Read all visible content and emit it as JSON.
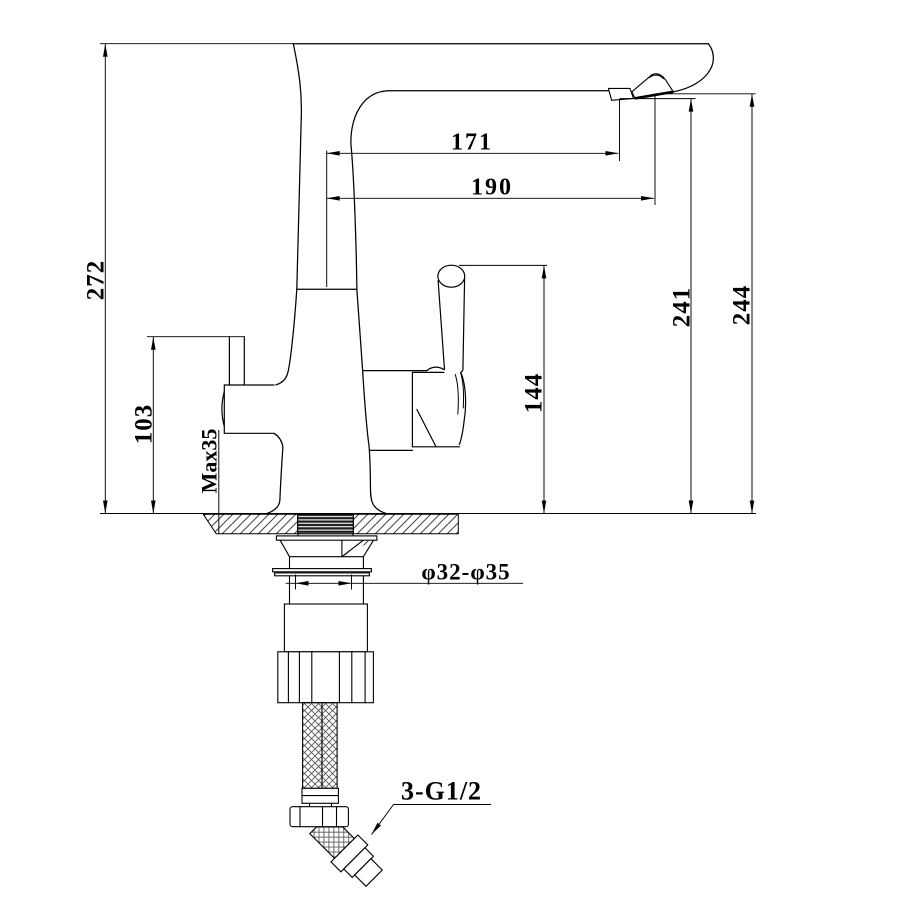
{
  "drawing": {
    "type": "technical-dimension-drawing",
    "subject": "kitchen faucet (3-way / filtered water mixer) front view with installation dimensions",
    "units": "mm",
    "line_color": "#000000",
    "background_color": "#ffffff",
    "dimensions": {
      "overall_height": "272",
      "spout_reach_inner": "171",
      "spout_reach_outer": "190",
      "outlet_height": "241",
      "tip_height": "244",
      "side_spout_height": "103",
      "max_deck_thickness": "Max35",
      "handle_top_height": "144",
      "mounting_hole_diameter": "φ32-φ35",
      "connection_thread": "3-G1/2"
    }
  }
}
